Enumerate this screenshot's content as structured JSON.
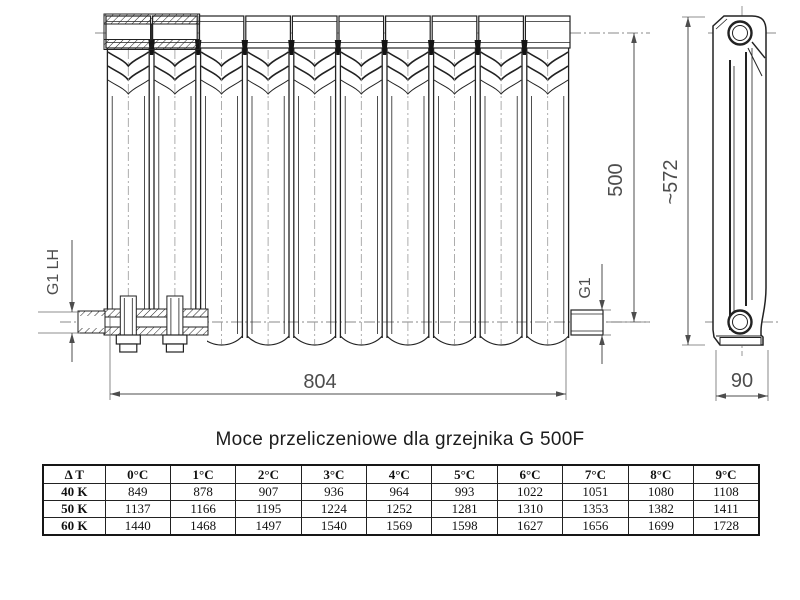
{
  "drawing": {
    "dims": {
      "width": "804",
      "axis_height": "500",
      "overall_height": "~572",
      "depth": "90",
      "left_connection": "G1 LH",
      "right_connection": "G1"
    }
  },
  "title": "Moce przeliczeniowe dla grzejnika G 500F",
  "table": {
    "headers": [
      "Δ T",
      "0°C",
      "1°C",
      "2°C",
      "3°C",
      "4°C",
      "5°C",
      "6°C",
      "7°C",
      "8°C",
      "9°C"
    ],
    "rows": [
      {
        "label": "40 K",
        "values": [
          "849",
          "878",
          "907",
          "936",
          "964",
          "993",
          "1022",
          "1051",
          "1080",
          "1108"
        ]
      },
      {
        "label": "50 K",
        "values": [
          "1137",
          "1166",
          "1195",
          "1224",
          "1252",
          "1281",
          "1310",
          "1353",
          "1382",
          "1411"
        ]
      },
      {
        "label": "60 K",
        "values": [
          "1440",
          "1468",
          "1497",
          "1540",
          "1569",
          "1598",
          "1627",
          "1656",
          "1699",
          "1728"
        ]
      }
    ]
  }
}
